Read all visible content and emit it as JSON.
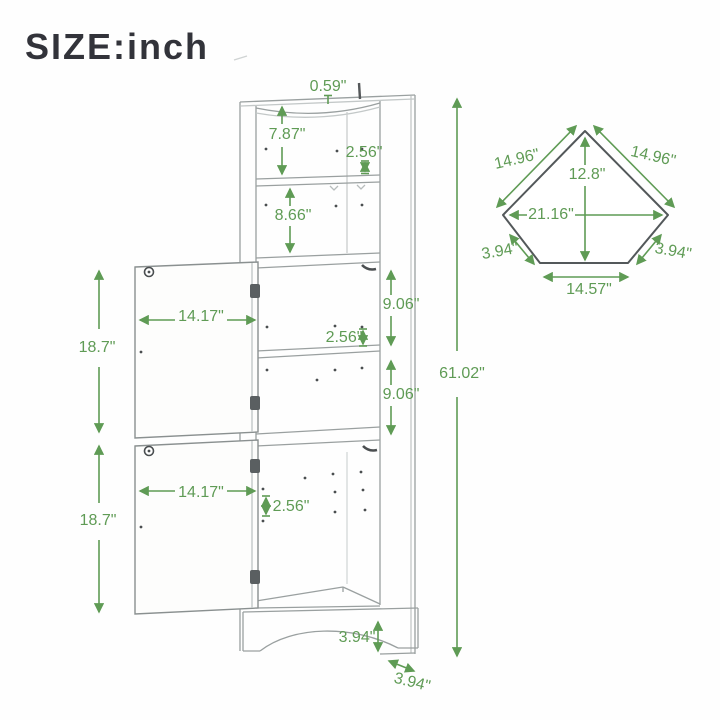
{
  "title": "SIZE:inch",
  "colors": {
    "dimension_green": "#5f9b55",
    "sketch_gray": "#9aa0a0",
    "outline_dark": "#53585a",
    "title_color": "#32333a"
  },
  "front_view": {
    "label": "cabinet front view sketch",
    "dimensions": {
      "top_thickness": "0.59\"",
      "top_shelf_height": "7.87\"",
      "top_hole_spacing": "2.56\"",
      "second_shelf_height": "8.66\"",
      "upper_door_width": "14.17\"",
      "middle_shelf_height_1": "9.06\"",
      "middle_hole_spacing": "2.56\"",
      "middle_shelf_height_2": "9.06\"",
      "upper_door_height": "18.7\"",
      "lower_door_width": "14.17\"",
      "lower_hole_spacing": "2.56\"",
      "lower_door_height": "18.7\"",
      "total_height": "61.02\"",
      "base_height": "3.94\"",
      "base_depth": "3.94\""
    }
  },
  "top_view": {
    "label": "corner top view sketch",
    "dimensions": {
      "left_side": "14.96\"",
      "right_side": "14.96\"",
      "depth": "12.8\"",
      "max_width": "21.16\"",
      "left_front_side": "3.94\"",
      "right_front_side": "3.94\"",
      "front_width": "14.57\""
    }
  }
}
